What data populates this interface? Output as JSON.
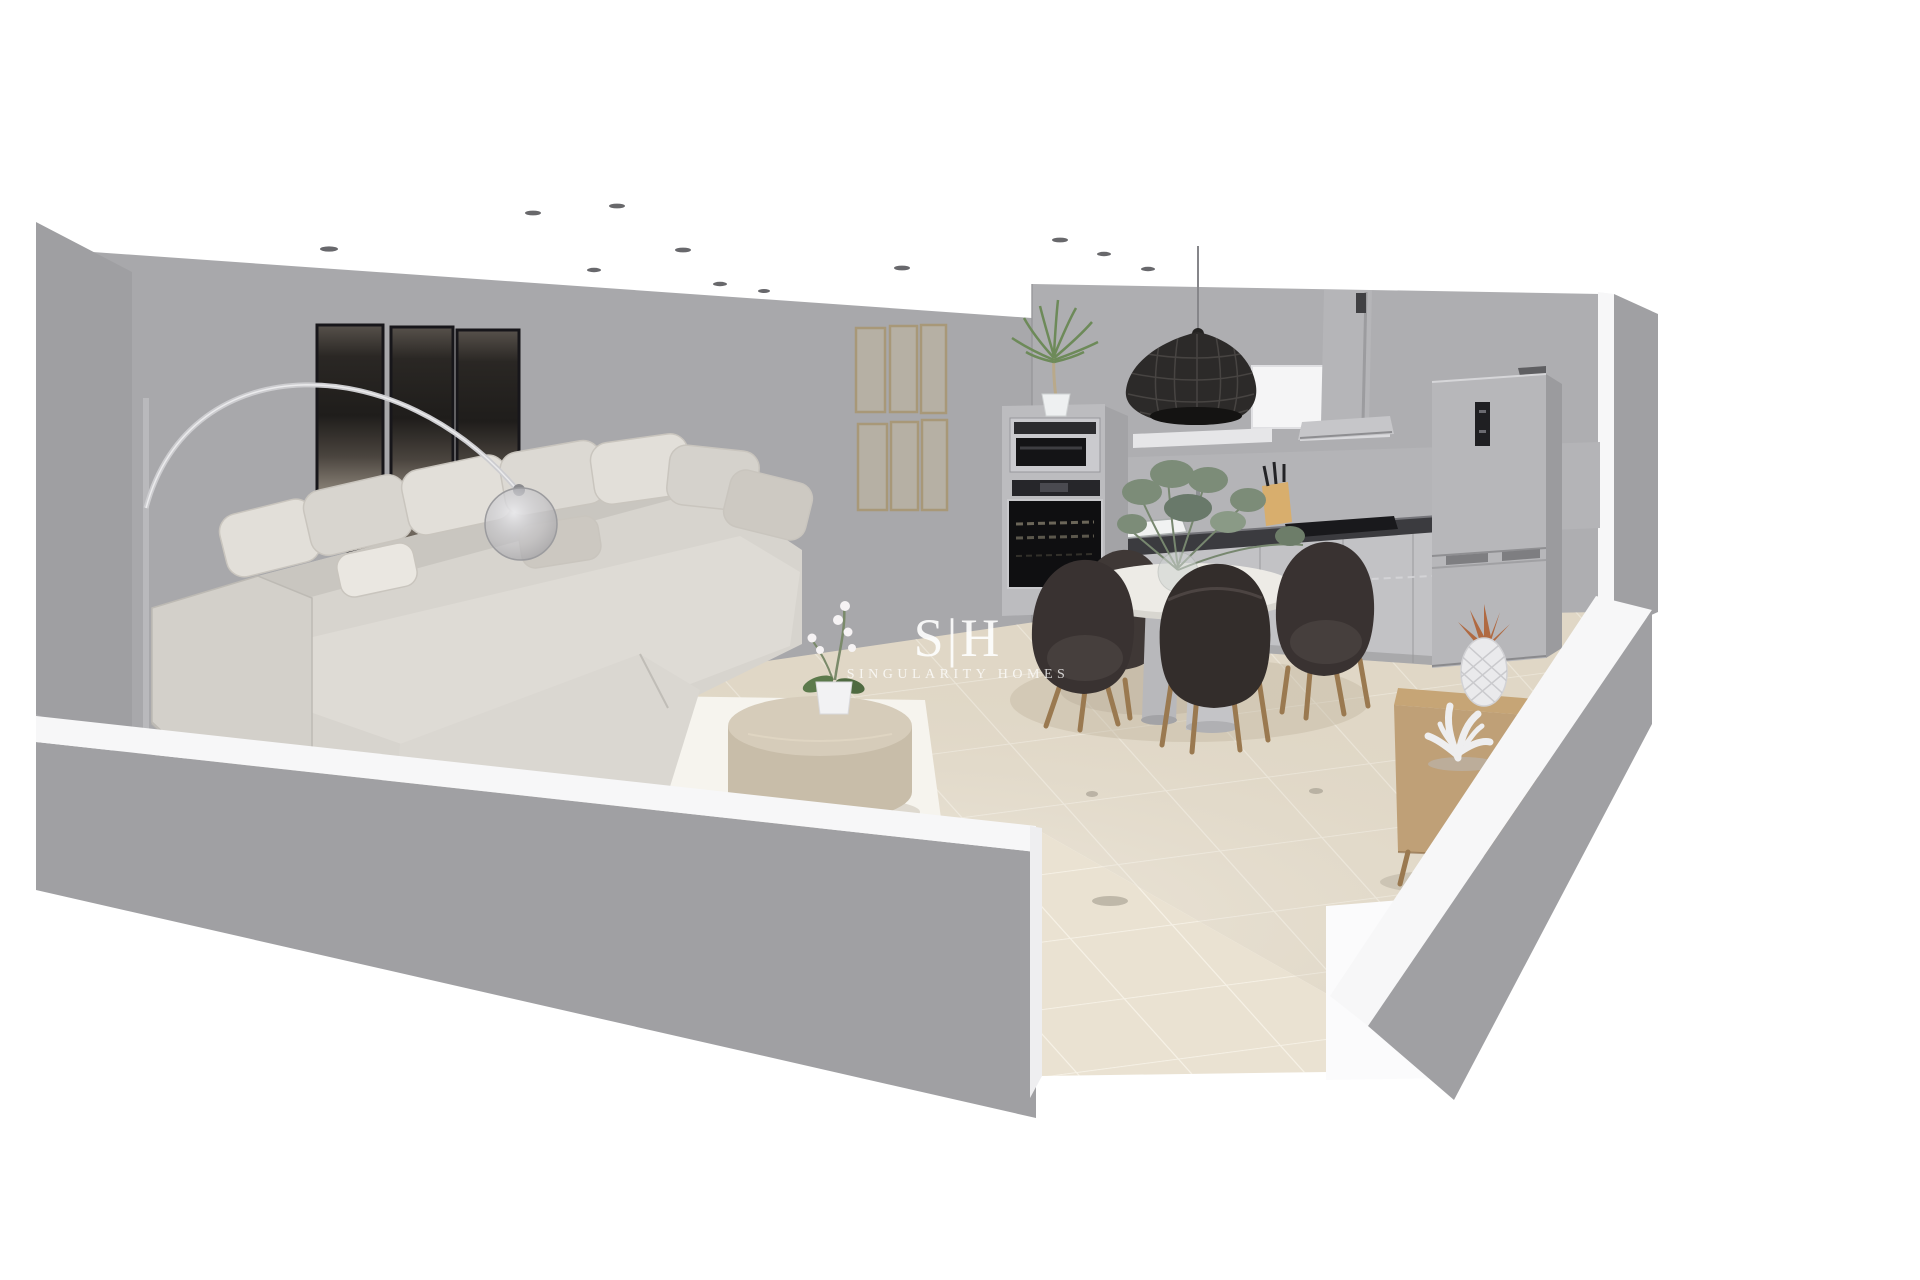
{
  "watermark": {
    "logo": "S|H",
    "company": "SINGULARITY HOMES"
  },
  "palette": {
    "background": "#ffffff",
    "wall_back": "#a8a8ab",
    "wall_left": "#9f9fa2",
    "wall_kitchen": "#aeaeb1",
    "wall_exterior": "#a0a0a3",
    "white_trim": "#f7f7f8",
    "floor_tile": "#eae2d2",
    "tile_grout": "#f8f3e8",
    "rug": "#f6f4ee",
    "rug_runner": "#d3c6ae",
    "sofa": "#d7d4ce",
    "sofa_shadow": "#c3c0ba",
    "pillow": "#e2dfd9",
    "artwork_dark": "#26231f",
    "frame_wood": "#a89878",
    "appliance_steel": "#bcbcbf",
    "appliance_glass": "#141416",
    "countertop": "#3b3b3f",
    "cabinet": "#c2c2c5",
    "pendant_black": "#2c2a29",
    "chair_dark": "#393231",
    "wood_light": "#c6a576",
    "wood_leg": "#9a7950",
    "plant_green": "#6d8a59",
    "eucalyptus": "#7c8c78",
    "copper": "#b06a42",
    "table_white": "#edebe6",
    "travertine": "#d6ccba"
  },
  "scene": {
    "room": "open-plan living room and kitchen, 3D dollhouse cutaway view",
    "ceiling_spotlights": 11,
    "objects": [
      "sectional sofa",
      "arc floor lamp",
      "triptych wall art",
      "potted palm",
      "round coffee table",
      "orchid pot",
      "area rug",
      "gallery wall frames",
      "oven and microwave column",
      "range hood",
      "cooktop",
      "kitchen sink",
      "knife block",
      "fridge freezer",
      "woven pendant lamp",
      "round dining table",
      "dining chairs",
      "eucalyptus centerpiece",
      "oak sideboard",
      "pineapple ornament",
      "coral ornament"
    ]
  }
}
